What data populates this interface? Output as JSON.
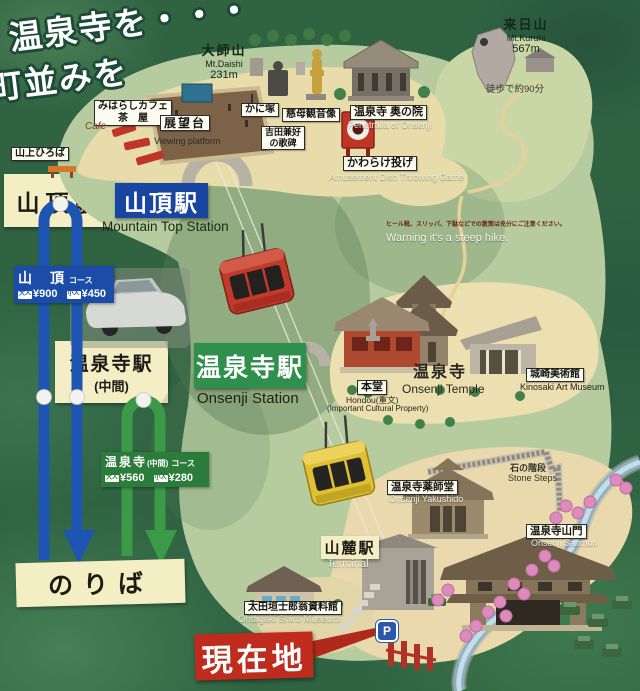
{
  "title": {
    "line1": "温泉寺を・・・",
    "line2": "町並みを"
  },
  "mountains": {
    "daishi": {
      "jp": "大師山",
      "en": "Mt.Daishi",
      "elev": "231m"
    },
    "kuruhi": {
      "jp": "来日山",
      "en": "Mt.Kuruhi",
      "elev": "567m",
      "walk": "徒歩で約90分"
    }
  },
  "warning": {
    "jp": "ヒール靴、スリッパ、下駄などでの散策は充分にご注意ください。",
    "en": "Warning  it's a steep hike."
  },
  "ropeway": {
    "top_panel": "山頂駅",
    "top_sign": "山頂駅",
    "top_sign_en": "Mountain Top Station",
    "mid_panel": "温泉寺駅",
    "mid_panel_sub": "(中間)",
    "mid_sign": "温泉寺駅",
    "mid_sign_en": "Onsenji Station",
    "base_panel": "山麓駅",
    "base_en": "Terminal",
    "boarding": "のりば",
    "fare_top": {
      "course": "山　頂",
      "course_suffix": "コース",
      "adult_label": "大人",
      "adult": "¥900",
      "child_label": "小人",
      "child": "¥450"
    },
    "fare_mid": {
      "course": "温泉寺",
      "course_mid": "(中間)",
      "course_suffix": "コース",
      "adult_label": "大人",
      "adult": "¥560",
      "child_label": "小人",
      "child": "¥280"
    }
  },
  "pois": {
    "cafe1": "みはらしカフェ",
    "cafe2": "茶　屋",
    "cafe_en": "Cafe",
    "viewing": "展望台",
    "viewing_en": "Viewing platform",
    "plaza": "山上ひろば",
    "kanizuka": "かに塚",
    "jibo": "慈母観音像",
    "yoshida1": "吉田兼好",
    "yoshida2": "の歌碑",
    "okunoin": "温泉寺 奥の院",
    "okunoin_en": "Penetralia of Onsenji",
    "kawarake": "かわらけ投げ",
    "kawarake_en": "Amusement Dish Throwing Game",
    "hondou": "本堂",
    "hondou_en1": "Hondou(重文)",
    "hondou_en2": "(Important Cultural Property)",
    "temple": "温泉寺",
    "temple_en": "Onsenji Temple",
    "art_museum": "城崎美術館",
    "art_museum_en": "Kinosaki Art Museum",
    "steps": "石の階段",
    "steps_en": "Stone Steps",
    "yakushido": "温泉寺薬師堂",
    "yakushido_en": "Onsenji Yakushido",
    "sanmon": "温泉寺山門",
    "sanmon_en": "Onsenji Sanmon",
    "shiro": "太田垣士郎翁資料館",
    "shiro_en": "Ohtagaki Shiro Museum"
  },
  "markers": {
    "current": "現在地",
    "parking": "P"
  },
  "colors": {
    "route_top": "#1e55b2",
    "route_mid": "#3b9a47",
    "current": "#bf2b1d",
    "panel": "#f4eec4"
  }
}
